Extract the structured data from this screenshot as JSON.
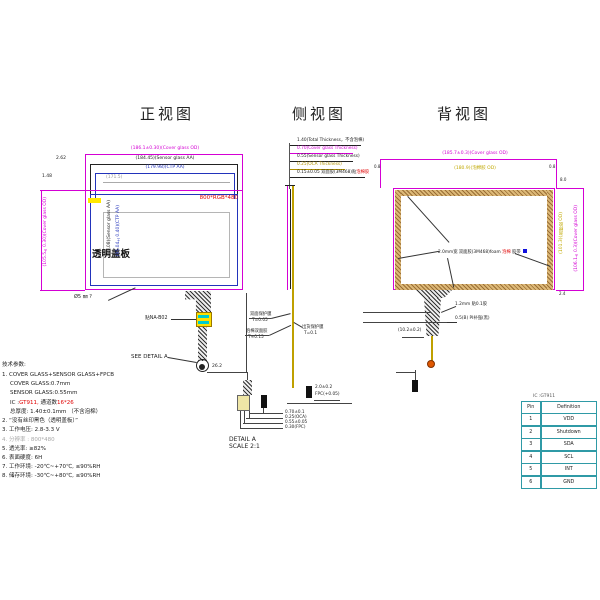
{
  "front": {
    "title": "正视图",
    "dim_cover_w": "(186.1±0.30)(Cover glass OD)",
    "dim_sensor_w": "(184.45)(Sensor glass AA)",
    "dim_aa_w": "(179.98)(CTP AA)",
    "dim_va_w": "(171.5)",
    "gap_top": "2.62",
    "gap_left": "1.48",
    "dim_cover_h": "(105.5±0.30)(Cover glass OD)",
    "dim_sensor_h": "(99.08)(Sensor glass AA)",
    "dim_aa_h": "(95.04±0.40)(CTP AA)",
    "resolution": "800*RGB*480",
    "panel_label": "透明盖板",
    "corner_note": "Ø5 ㎜ ?",
    "connector_label": "贴NA-B02",
    "see_detail": "SEE DETAIL A",
    "tail_dim": "26.2"
  },
  "side": {
    "title": "侧视图",
    "stack1": "1.40(Total Thickness，不含泡棉)",
    "stack2": "0.70(Cover glass Thickness)",
    "stack3": "0.55(Sensor glass Thickness)",
    "stack4": "0.25(OCA Thickness)",
    "stack5": "0.15±0.05 双面胶(3M468)贴",
    "stack5_red": "泡棉胶",
    "mid1_l1": "双面保护膜",
    "mid1_l2": "T=0.05",
    "mid2_l1": "泡棉双面胶",
    "mid2_l2": "T≈0.15",
    "mid3_l1": "出货保护膜",
    "mid3_l2": "T=0.1",
    "bottom_dim": "2.0±0.2",
    "bottom_note": "FPC(+0.05)"
  },
  "back": {
    "title": "背视图",
    "dim_cover_w": "(185.7±0.3)(Cover glass OD)",
    "dim_foam_w": "(180.9)(泡棉胶 OD)",
    "edge_tl": "0.8",
    "edge_tr": "0.8",
    "right_top": "8.0",
    "right_bottom": "2.4",
    "dim_cover_h": "(106.1±0.3)(Cover glass OD)",
    "dim_foam_h": "(101.3)(泡棉胶 OD)",
    "center_pre": "2.0mm宽 双面胶(3M468)foam ",
    "center_red": "泡棉",
    "center_post": " 胶带",
    "tail_dim": "(10.2±0.2)",
    "tail_l1": "1.2mm 贴0.1胶",
    "tail_l2": "0.5(B) PI补强(黑)"
  },
  "detail_a": {
    "name": "DETAIL A",
    "scale": "SCALE 2:1",
    "l1": "0.70±0.1",
    "l2": "0.25(OCA)",
    "l3": "0.55±0.05",
    "l4": "0.30(FPC)"
  },
  "tech": {
    "heading": "技术参数:",
    "l1": "1. COVER GLASS+SENSOR GLASS+FPCB",
    "l2": "COVER GLASS:0.7mm",
    "l3": "SENSOR GLASS:0.55mm",
    "l4_pre": "IC :",
    "l4_red1": "GT911,",
    "l4_mid": " 通道数",
    "l4_red2": "16*26",
    "l5": "总厚度: 1.40±0.1mm （不含泡棉）",
    "l6": "2. “没有丝印黑色（透明盖板）”",
    "l7": "3. 工作电压: 2.8-3.3 V",
    "l8": "4. 分辨率 : 800*480",
    "l9": "5. 透光率: ≥82%",
    "l10": "6. 表面硬度: 6H",
    "l11": "7. 工作环境: -20℃~+70℃, ≤90%RH",
    "l12": "8. 储存环境: -30℃~+80℃, ≤90%RH"
  },
  "pin_table": {
    "caption": "IC :GT911",
    "headers": [
      "Pin",
      "Definition"
    ],
    "rows": [
      [
        "1",
        "VDD"
      ],
      [
        "2",
        "Shutdown"
      ],
      [
        "3",
        "SDA"
      ],
      [
        "4",
        "SCL"
      ],
      [
        "5",
        "INT"
      ],
      [
        "6",
        "GND"
      ]
    ]
  }
}
